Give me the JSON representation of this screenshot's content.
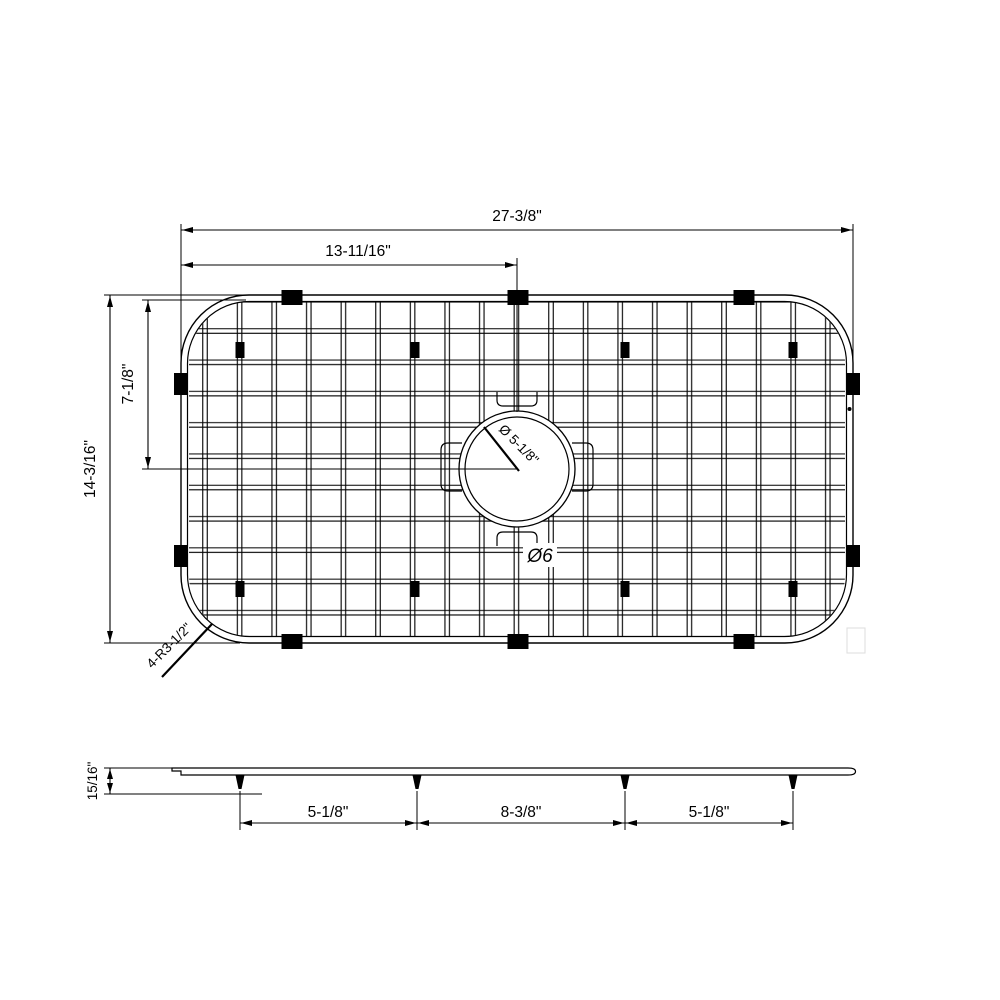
{
  "figure": {
    "type": "technical-dimension-drawing",
    "background": "#ffffff",
    "line_color": "#000000",
    "top_view": {
      "overall_width": "27-3/8\"",
      "hole_center_from_left": "13-11/16\"",
      "overall_depth": "14-3/16\"",
      "hole_center_from_top": "7-1/8\"",
      "hole_diameter": "Ø 5-1/8\"",
      "hole_note": "Ø6",
      "corner_radius_note": "4-R3-1/2\""
    },
    "side_view": {
      "thickness": "15/16\"",
      "feet_spacing": [
        "5-1/8\"",
        "8-3/8\"",
        "5-1/8\""
      ]
    }
  }
}
